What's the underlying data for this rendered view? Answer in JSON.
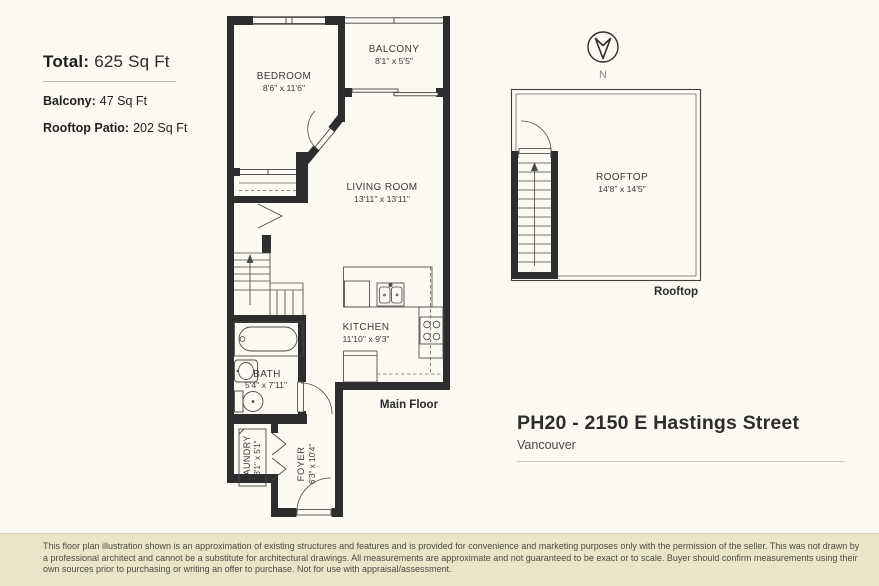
{
  "colors": {
    "background": "#fbf9f2",
    "wall": "#2d2d2d",
    "thin_line": "#3f3f3f",
    "disclaimer_bg": "#ebe4c9"
  },
  "stats": {
    "total_label": "Total:",
    "total_value": "625 Sq Ft",
    "balcony_label": "Balcony:",
    "balcony_value": "47 Sq Ft",
    "rooftop_label": "Rooftop Patio:",
    "rooftop_value": "202 Sq Ft"
  },
  "address": {
    "title": "PH20 - 2150 E Hastings Street",
    "city": "Vancouver"
  },
  "compass": {
    "label": "N"
  },
  "floors": {
    "main": {
      "caption": "Main Floor",
      "rooms": {
        "bedroom": {
          "name": "BEDROOM",
          "dims": "8'6\" x 11'6\""
        },
        "balcony": {
          "name": "BALCONY",
          "dims": "8'1\" x 5'5\""
        },
        "living_room": {
          "name": "LIVING ROOM",
          "dims": "13'11\" x 13'11\""
        },
        "kitchen": {
          "name": "KITCHEN",
          "dims": "11'10\" x 9'3\""
        },
        "bath": {
          "name": "BATH",
          "dims": "5'4\" x 7'11\""
        },
        "laundry": {
          "name": "LAUNDRY",
          "dims": "3'1\" x 5'1\""
        },
        "foyer": {
          "name": "FOYER",
          "dims": "6'3\" x 10'4\""
        }
      }
    },
    "rooftop": {
      "caption": "Rooftop",
      "rooms": {
        "rooftop": {
          "name": "ROOFTOP",
          "dims": "14'8\" x 14'5\""
        }
      }
    }
  },
  "disclaimer": {
    "text": "This floor plan illustration shown is an approximation of existing structures and features and is provided for convenience and marketing purposes only with the permission of the seller. This was not drawn by a professional architect and cannot be a substitute for architectural drawings. All measurements are approximate and not guaranteed to be exact or to scale. Buyer should confirm measurements using their own sources prior to purchasing or writing an offer to purchase. Not for use with appraisal/assessment."
  }
}
